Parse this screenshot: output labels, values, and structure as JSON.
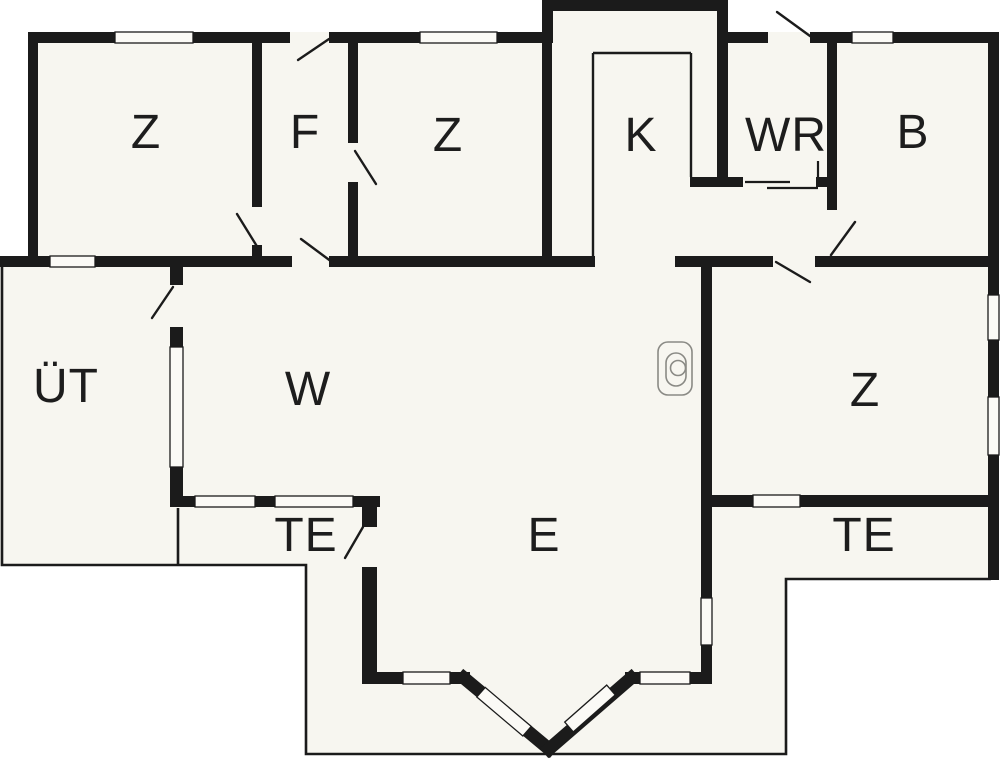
{
  "document": {
    "type": "floor-plan"
  },
  "colors": {
    "wall": "#1b1b1b",
    "interior_fill": "#f7f6f0",
    "outside": "#ffffff",
    "window_fill": "#fbfaf6",
    "fixture_stroke": "#8a8a85",
    "label_color": "#1d1d1d"
  },
  "rooms": [
    {
      "id": "bedroom-top-left",
      "label": "Z"
    },
    {
      "id": "vestibule",
      "label": "F"
    },
    {
      "id": "bedroom-top-middle",
      "label": "Z"
    },
    {
      "id": "kitchen",
      "label": "K"
    },
    {
      "id": "utility-room",
      "label": "WR"
    },
    {
      "id": "bathroom",
      "label": "B"
    },
    {
      "id": "covered-terrace",
      "label": "ÜT"
    },
    {
      "id": "living-room",
      "label": "W"
    },
    {
      "id": "bedroom-right",
      "label": "Z"
    },
    {
      "id": "terrace-left",
      "label": "TE"
    },
    {
      "id": "dining-area",
      "label": "E"
    },
    {
      "id": "terrace-right",
      "label": "TE"
    }
  ]
}
